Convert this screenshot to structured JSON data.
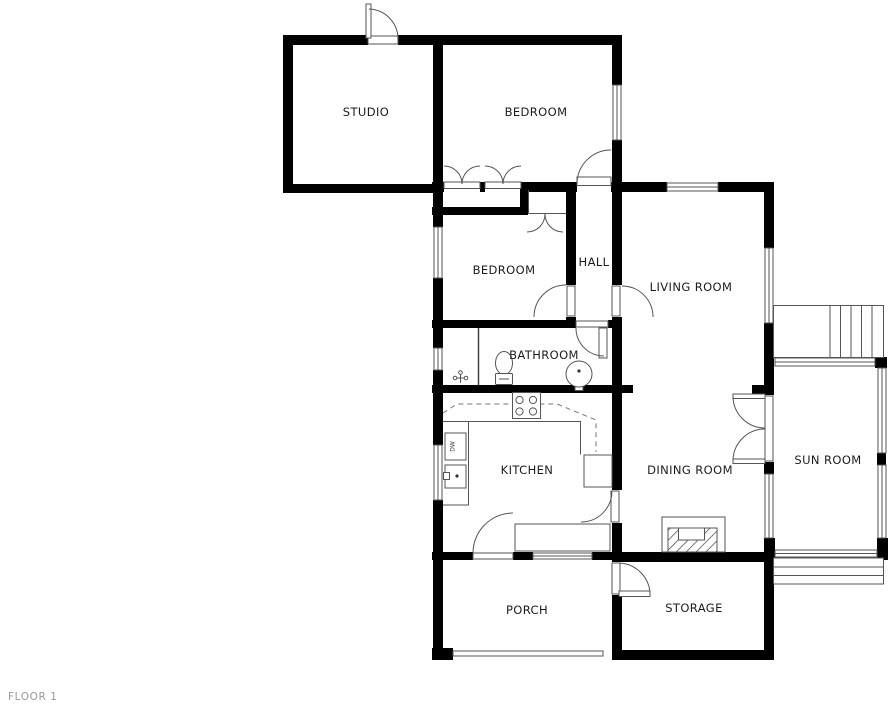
{
  "floor_label": "FLOOR 1",
  "rooms": {
    "studio": "STUDIO",
    "bedroom_top": "BEDROOM",
    "bedroom_mid": "BEDROOM",
    "hall": "HALL",
    "living": "LIVING ROOM",
    "bathroom": "BATHROOM",
    "kitchen": "KITCHEN",
    "dining": "DINING ROOM",
    "sunroom": "SUN ROOM",
    "porch": "PORCH",
    "storage": "STORAGE"
  },
  "fixtures": {
    "dishwasher_label": "DW"
  },
  "colors": {
    "wall": "#000000",
    "fixture_line": "#555555",
    "dashed_cabinet_line": "#777777",
    "room_label": "#1c1c1c",
    "floor_label": "#9a9a9a",
    "background": "#ffffff"
  }
}
